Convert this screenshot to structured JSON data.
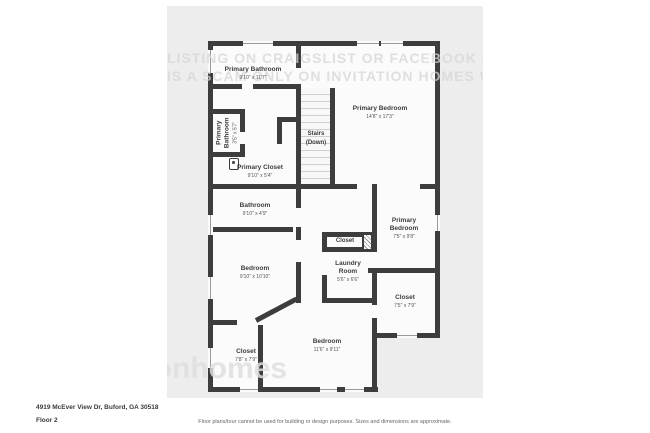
{
  "page": {
    "canvas_color": "#ededed",
    "wall_color": "#3d3d3d",
    "room_fill": "#fbfbfb"
  },
  "rooms": [
    {
      "id": "primary-bathroom",
      "name": "Primary Bathroom",
      "dims": "9'10\" x 11'7\""
    },
    {
      "id": "primary-bathroom-small",
      "name": "Primary Bathroom",
      "dims": "3'5\" x 5'7\""
    },
    {
      "id": "stairs",
      "name": "Stairs",
      "dims": "(Down)"
    },
    {
      "id": "primary-bedroom",
      "name": "Primary Bedroom",
      "dims": "14'8\" x 17'3\""
    },
    {
      "id": "primary-closet",
      "name": "Primary Closet",
      "dims": "9'10\" x 5'4\""
    },
    {
      "id": "bathroom",
      "name": "Bathroom",
      "dims": "9'10\" x 4'9\""
    },
    {
      "id": "hall-closet",
      "name": "Closet",
      "dims": ""
    },
    {
      "id": "primary-bedroom-2",
      "name": "Primary Bedroom",
      "dims": "7'5\" x 9'8\""
    },
    {
      "id": "laundry-room",
      "name": "Laundry Room",
      "dims": "5'6\" x 6'6\""
    },
    {
      "id": "bedroom-1",
      "name": "Bedroom",
      "dims": "9'10\" x 10'10\""
    },
    {
      "id": "closet-right",
      "name": "Closet",
      "dims": "7'5\" x 7'9\""
    },
    {
      "id": "closet-left",
      "name": "Closet",
      "dims": "7'8\" x 7'9\""
    },
    {
      "id": "bedroom-2",
      "name": "Bedroom",
      "dims": "11'6\" x 9'11\""
    }
  ],
  "watermark": {
    "top_line_1": "LISTING ON CRAIGSLIST OR FACEBOOK MARKETPLACE",
    "top_line_2": "IS A SCAM ONLY ON INVITATION HOMES WEBSITE",
    "logo": "invitationhomes"
  },
  "footer": {
    "address": "4919 McEver View Dr, Buford, GA 30518",
    "floor": "Floor 2",
    "disclaimer": "Floor plans/tour cannot be used for building or design purposes. Sizes and dimensions are approximate."
  }
}
